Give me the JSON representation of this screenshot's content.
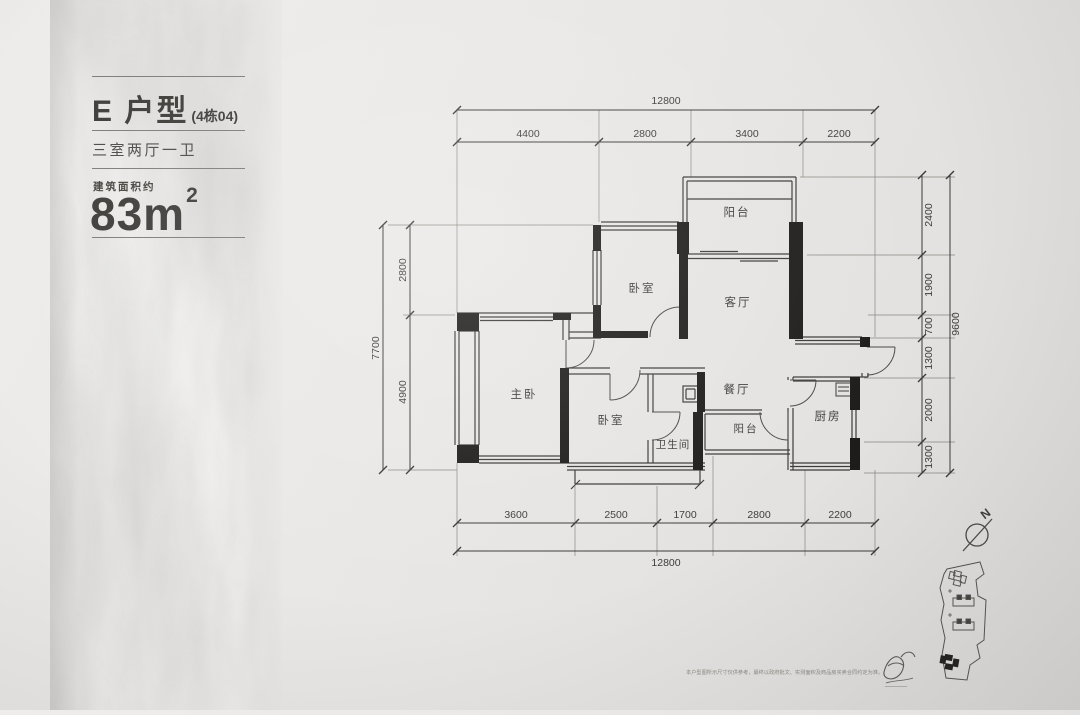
{
  "panel": {
    "title": "E 户型",
    "title_suffix": "(4栋04)",
    "layout": "三室两厅一卫",
    "area_label": "建筑面积约",
    "area_value": "83m",
    "area_exponent": "2"
  },
  "rooms": {
    "balcony_top": "阳台",
    "bedroom_top": "卧室",
    "living": "客厅",
    "master": "主卧",
    "bedroom_mid": "卧室",
    "bathroom": "卫生间",
    "dining": "餐厅",
    "balcony_service": "阳台",
    "kitchen": "厨房"
  },
  "dimensions": {
    "top": {
      "total": "12800",
      "segments": [
        "4400",
        "2800",
        "3400",
        "2200"
      ]
    },
    "bottom": {
      "total": "12800",
      "segments": [
        "3600",
        "2500",
        "1700",
        "2800",
        "2200"
      ]
    },
    "left": {
      "total": "7700",
      "segments": [
        "2800",
        "4900"
      ]
    },
    "right": {
      "total": "9600",
      "segments": [
        "2400",
        "1900",
        "700",
        "1300",
        "2000",
        "1300"
      ]
    }
  },
  "compass": {
    "label": "N"
  },
  "footer": {
    "disclaimer": "本户型图所示尺寸仅供参考，最终以政府批文、实测面积及商品房买卖合同约定为准。"
  },
  "colors": {
    "wall": "#1d1c1a",
    "line": "#3b3a38",
    "text": "#3d3c3a",
    "accent": "#4a4946"
  }
}
